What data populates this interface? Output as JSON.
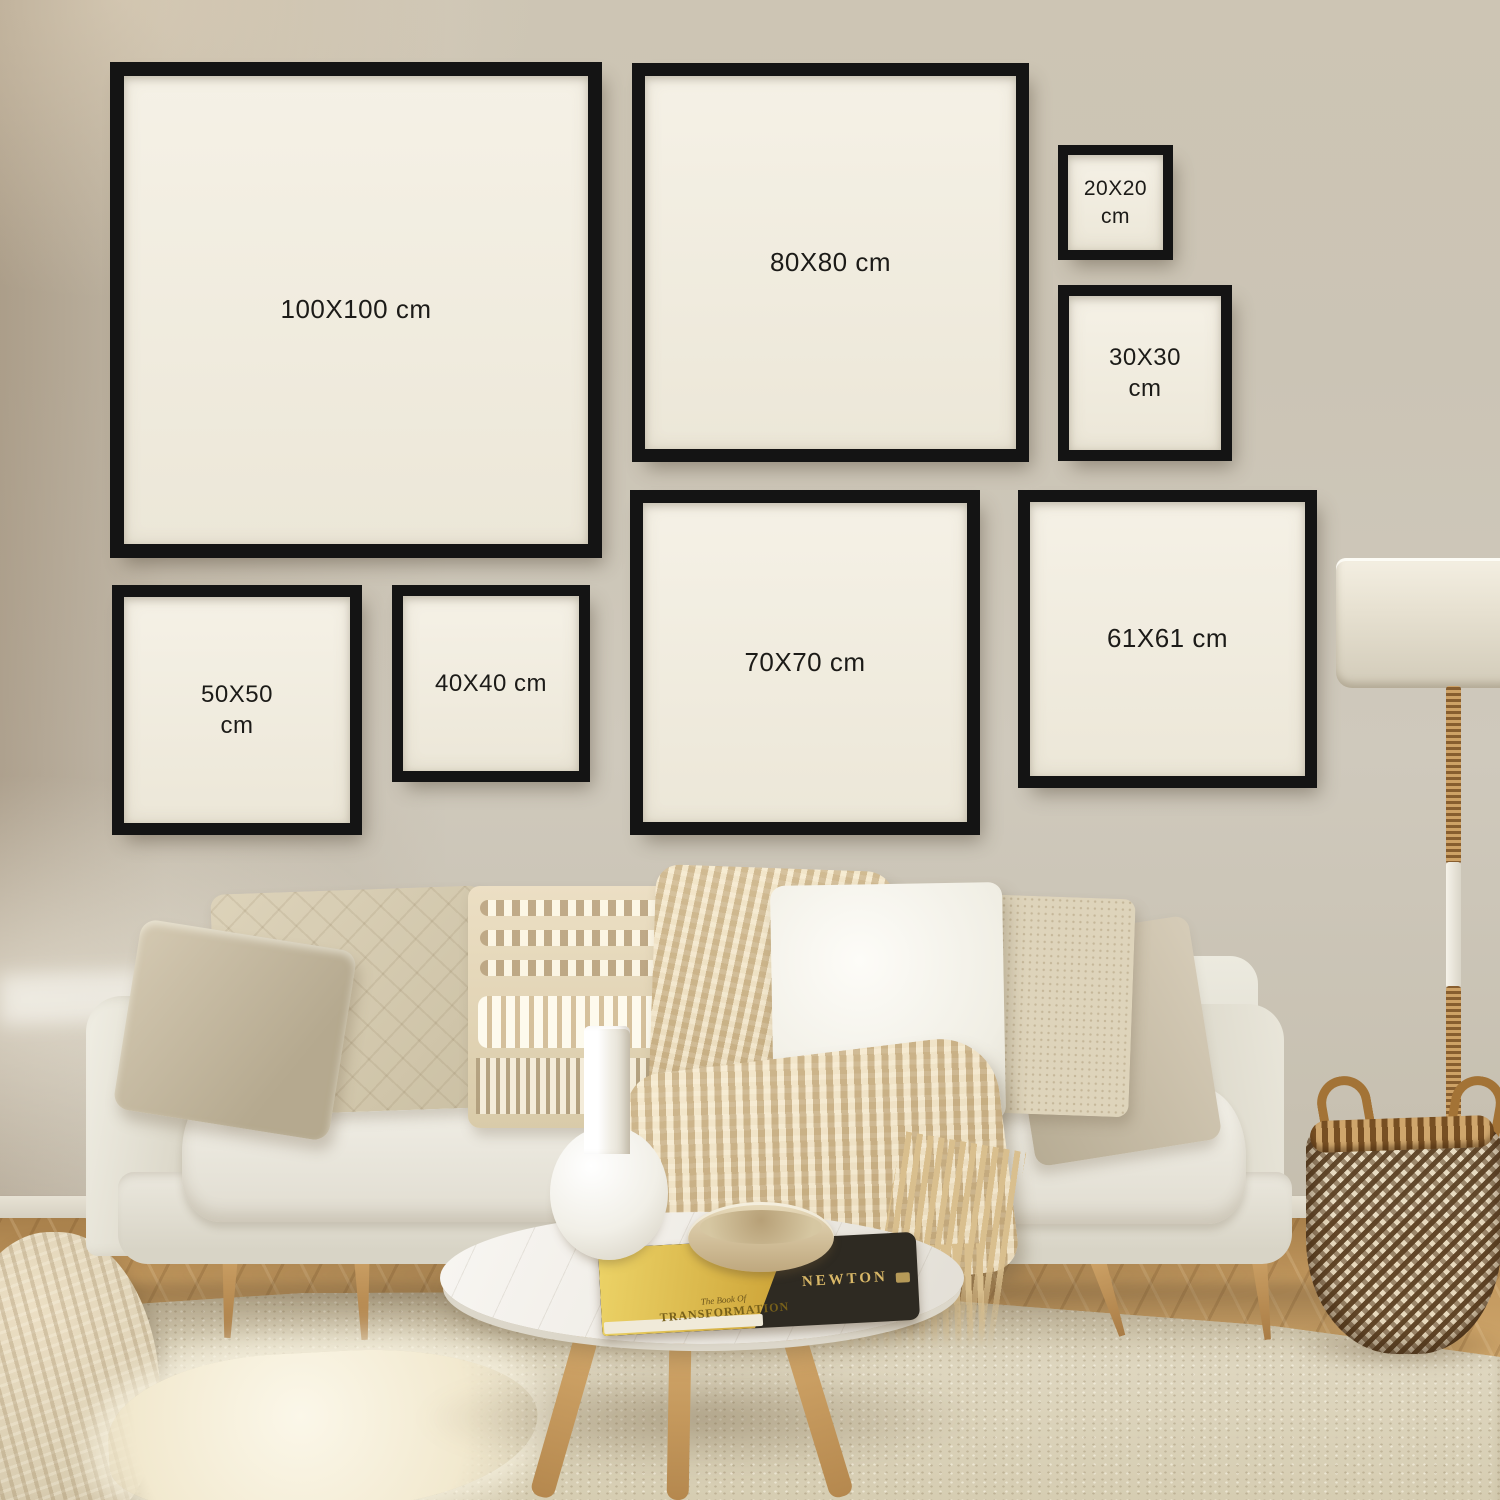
{
  "frames": [
    {
      "name": "100x100",
      "line1": "100X100 cm",
      "line2": ""
    },
    {
      "name": "80x80",
      "line1": "80X80 cm",
      "line2": ""
    },
    {
      "name": "20x20",
      "line1": "20X20",
      "line2": "cm"
    },
    {
      "name": "30x30",
      "line1": "30X30",
      "line2": "cm"
    },
    {
      "name": "50x50",
      "line1": "50X50",
      "line2": "cm"
    },
    {
      "name": "40x40",
      "line1": "40X40 cm",
      "line2": ""
    },
    {
      "name": "70x70",
      "line1": "70X70 cm",
      "line2": ""
    },
    {
      "name": "61x61",
      "line1": "61X61 cm",
      "line2": ""
    }
  ],
  "book": {
    "spine_title": "NEWTON",
    "cover_line1": "The Book Of",
    "cover_line2": "TRANSFORMATION"
  },
  "palette": {
    "frame_border": "#141414",
    "frame_mat": "#f3efe4",
    "label_text": "#1c1b18",
    "wall_left": "#bcab94",
    "wall_right": "#ccc6ba",
    "sofa_fabric": "#e6e3da",
    "wood_floor": "#b98c55",
    "rug": "#d8cfb6",
    "basket_dark": "#5e4326",
    "basket_light": "#e9dcc2",
    "throw_knit": "#e0ceaa",
    "lamp_shade": "#e9e4d6",
    "book_gold": "#d4ab3c",
    "book_dark": "#2e2a22"
  }
}
